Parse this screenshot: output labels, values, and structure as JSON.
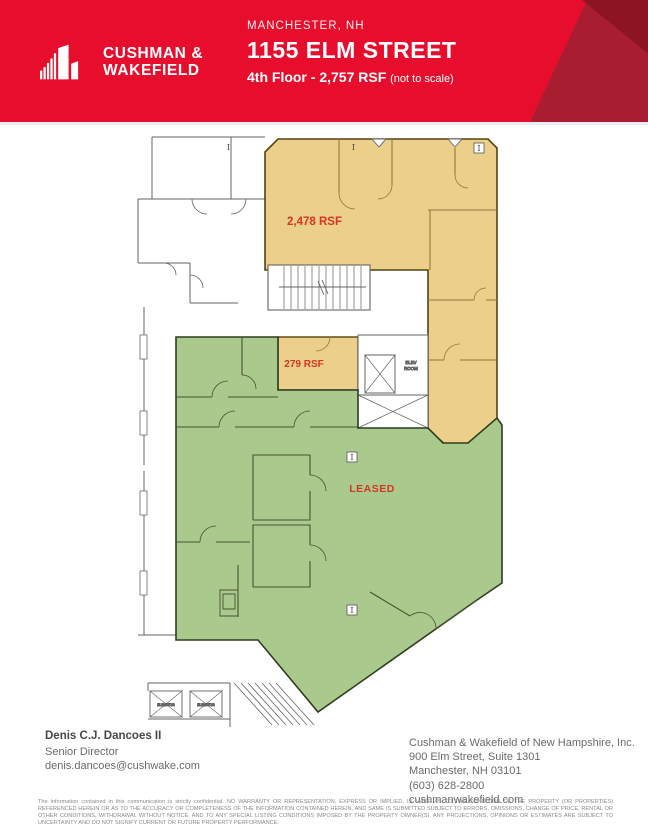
{
  "header": {
    "brand_line1": "CUSHMAN &",
    "brand_line2": "WAKEFIELD",
    "location": "MANCHESTER, NH",
    "address": "1155 ELM STREET",
    "floor_line": "4th Floor - 2,757 RSF",
    "floor_note": "(not to scale)",
    "colors": {
      "red": "#e60e2c",
      "dark_red": "#a81d30",
      "darker_red": "#8c1423"
    }
  },
  "floorplan": {
    "available_large_label": "2,478 RSF",
    "available_small_label": "279 RSF",
    "leased_label": "LEASED",
    "elev_room_line1": "ELEV",
    "elev_room_line2": "ROOM",
    "elevator_label": "ELEVATOR",
    "column_marker": "I",
    "colors": {
      "available_fill": "#eccf8b",
      "available_outline": "#55430f",
      "leased_fill": "#a9c98d",
      "leased_outline": "#2f3d1f",
      "label_red": "#d63426",
      "wall_gray": "#646464"
    }
  },
  "contact": {
    "name": "Denis C.J. Dancoes II",
    "title": "Senior Director",
    "email": "denis.dancoes@cushwake.com"
  },
  "company": {
    "name": "Cushman & Wakefield of New Hampshire, Inc.",
    "address_line1": "900 Elm Street, Suite 1301",
    "address_line2": "Manchester, NH 03101",
    "phone": "(603) 628-2800",
    "website": "cushmanwakefield.com"
  },
  "disclaimer": "The information contained in this communication is strictly confidential. NO WARRANTY OR REPRESENTATION, EXPRESS OR IMPLIED, IS MADE AS TO THE CONDITION OF THE PROPERTY (OR PROPERTIES) REFERENCED HEREIN OR AS TO THE ACCURACY OR COMPLETENESS OF THE INFORMATION CONTAINED HEREIN, AND SAME IS SUBMITTED SUBJECT TO ERRORS, OMISSIONS, CHANGE OF PRICE, RENTAL OR OTHER CONDITIONS, WITHDRAWAL WITHOUT NOTICE, AND TO ANY SPECIAL LISTING CONDITIONS IMPOSED BY THE PROPERTY OWNER(S). ANY PROJECTIONS, OPINIONS OR ESTIMATES ARE SUBJECT TO UNCERTAINTY AND DO NOT SIGNIFY CURRENT OR FUTURE PROPERTY PERFORMANCE."
}
